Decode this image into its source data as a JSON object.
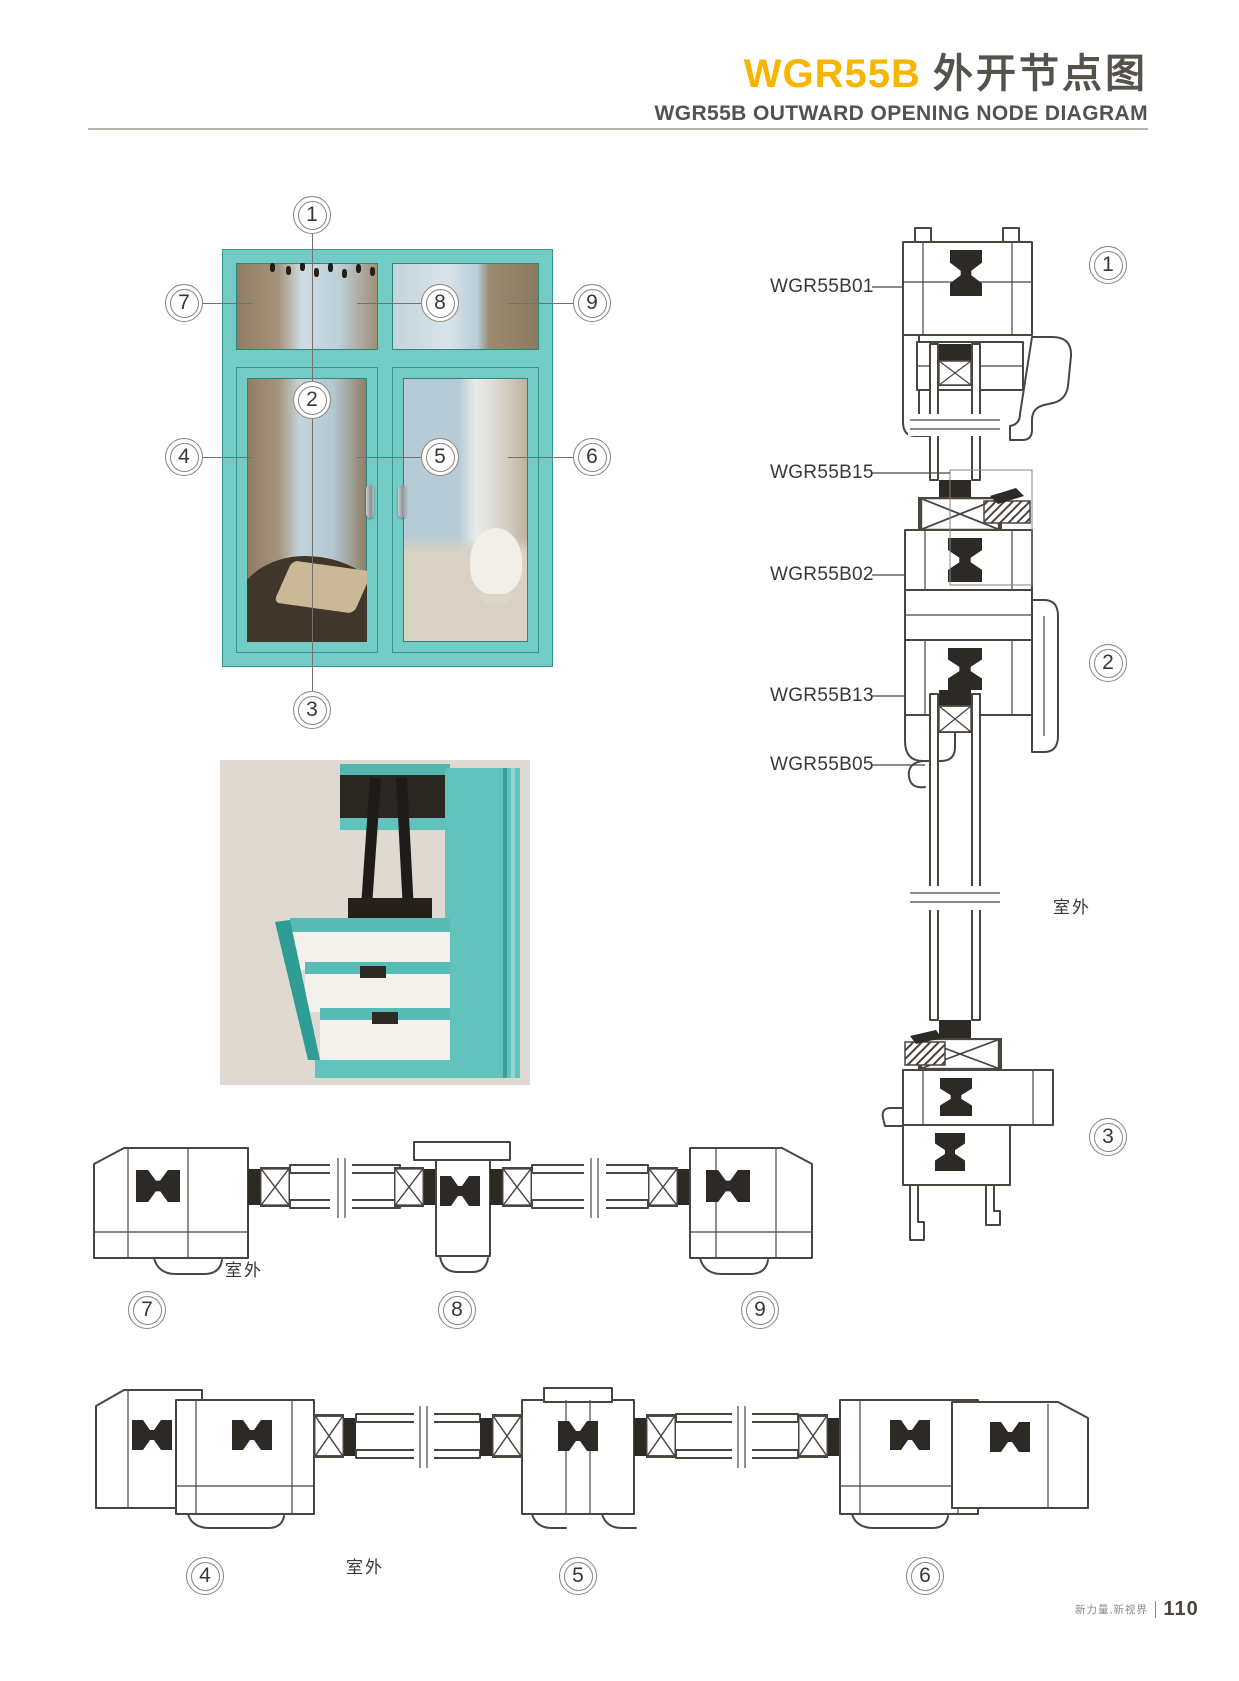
{
  "header": {
    "model": "WGR55B",
    "title_cn": "外开节点图",
    "subtitle": "WGR55B OUTWARD OPENING NODE DIAGRAM",
    "accent_color": "#F7B500",
    "text_color": "#55514B"
  },
  "window_diagram": {
    "frame_color": "#73CBC5",
    "callouts": {
      "c1": "1",
      "c2": "2",
      "c3": "3",
      "c4": "4",
      "c5": "5",
      "c6": "6",
      "c7": "7",
      "c8": "8",
      "c9": "9"
    }
  },
  "vertical_section": {
    "part_labels": [
      "WGR55B01",
      "WGR55B15",
      "WGR55B02",
      "WGR55B13",
      "WGR55B05"
    ],
    "callouts": [
      "1",
      "2",
      "3"
    ],
    "outdoor_label": "室外"
  },
  "horizontal_section_top": {
    "outdoor_label": "室外",
    "callouts": [
      "7",
      "8",
      "9"
    ]
  },
  "horizontal_section_bottom": {
    "outdoor_label": "室外",
    "callouts": [
      "4",
      "5",
      "6"
    ]
  },
  "footer": {
    "slogan": "新力量,新视界",
    "page_number": "110"
  }
}
